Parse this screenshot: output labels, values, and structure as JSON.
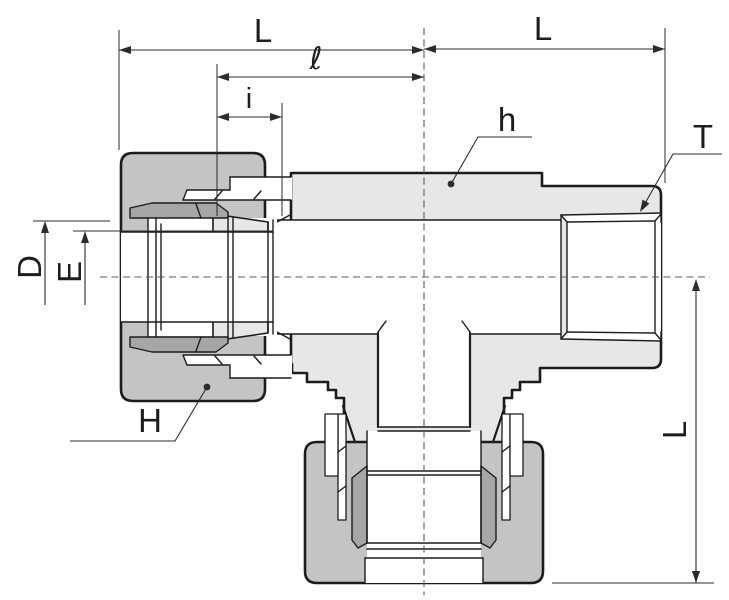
{
  "diagram": {
    "title": "tee-compression-fitting-cross-section",
    "labels": {
      "run_left_length": "L",
      "run_right_length": "L",
      "branch_length": "L",
      "insert_total": "ℓ",
      "insert_depth": "i",
      "body_hex": "h",
      "thread_size": "T",
      "nut_hex": "H",
      "tube_hole_dia": "D",
      "bore_dia": "E"
    },
    "colors": {
      "bg": "#ffffff",
      "body": "#e7e7e7",
      "nut": "#c4c4c4",
      "wedge": "#a6a6a6",
      "line": "#1c1c1c",
      "dim": "#2b2b2b",
      "centerline": "#5a5a5a"
    }
  }
}
